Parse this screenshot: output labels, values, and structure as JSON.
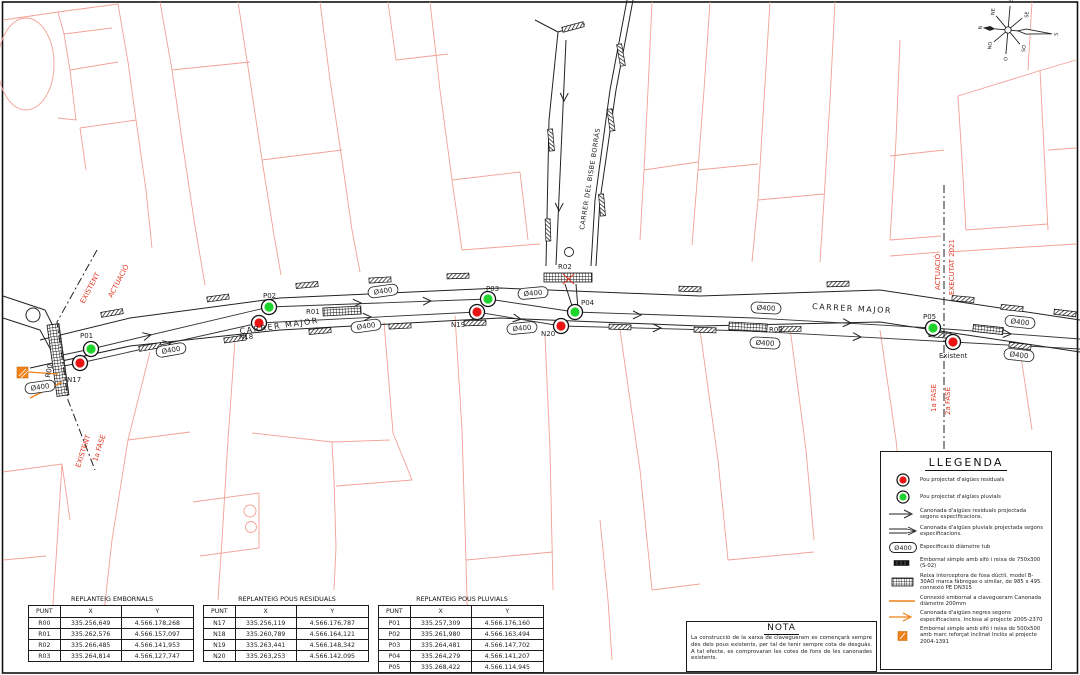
{
  "drawing": {
    "streets": {
      "carrer_major": "CARRER MAJOR",
      "carrer_bisbe": "CARRER DEL BISBE BORRÀS"
    },
    "diameter_label": "Ø400",
    "points": {
      "pluvial": [
        "P01",
        "P02",
        "P03",
        "P04",
        "P05"
      ],
      "residual": [
        "N17",
        "N18",
        "N19",
        "N20"
      ],
      "reixes": [
        "R00",
        "R01",
        "R02",
        "R03"
      ],
      "existent": "Existent"
    },
    "phases": {
      "left_top": [
        "EXISTENT",
        "ACTUACIÓ"
      ],
      "left_bottom": [
        "EXISTENT",
        "1a FASE"
      ],
      "right_top": [
        "ACTUACIÓ",
        "EXECUTAT 2021"
      ],
      "right_bottom": [
        "1a FASE",
        "2a FASE"
      ]
    },
    "compass": [
      "N",
      "NE",
      "E",
      "SE",
      "S",
      "SO",
      "O",
      "NO"
    ]
  },
  "legend": {
    "title": "LLEGENDA",
    "items": [
      {
        "symbol": "pou-residual-icon",
        "label": "Pou projectat d'aigües residuals"
      },
      {
        "symbol": "pou-pluvial-icon",
        "label": "Pou projectat d'aigües pluvials"
      },
      {
        "symbol": "pipe-residual-icon",
        "label": "Canonada d'aigües residuals projectada segons especificacions."
      },
      {
        "symbol": "pipe-pluvial-icon",
        "label": "Canonada d'aigües pluvials projectada segons especificacions."
      },
      {
        "symbol": "diameter-badge-icon",
        "label": "Especificació diàmetre tub"
      },
      {
        "symbol": "embornal-icon",
        "label": "Embornal simple amb sifó i reixa de 750x300 (S-02)"
      },
      {
        "symbol": "reixa-icon",
        "label": "Reixa interceptora de fosa dúctil, model B-30AO marca fàbregas o similar, de 985 x 495. connexió PE DN315"
      },
      {
        "symbol": "connexio-icon",
        "label": "Connexió embornal a clavegueram Canonada diàmetre 200mm"
      },
      {
        "symbol": "negres-icon",
        "label": "Canonada d'aigües negres segons especificacions. Inclosa al projecte 2005-2370"
      },
      {
        "symbol": "embornal-500-icon",
        "label": "Embornal simple amb sifó i reixa de 500x500 amb marc reforçat inclinat Inclòs al projecte 2004-1391"
      }
    ]
  },
  "note": {
    "title": "NOTA",
    "body": "La construcció de la xarxa de clavegueram es començarà sempre des dels pous existents, per tal de tenir sempre cota de desguàs. A tal efecte, es comprovaran les cotes de fons de les canonades existents."
  },
  "tables": [
    {
      "title": "REPLANTEIG EMBORNALS",
      "headers": [
        "PUNT",
        "X",
        "Y"
      ],
      "rows": [
        [
          "R00",
          "335.256,649",
          "4.566.178,268"
        ],
        [
          "R01",
          "335.262,576",
          "4.566.157,097"
        ],
        [
          "R02",
          "335.266,485",
          "4.566.141,953"
        ],
        [
          "R03",
          "335.264,814",
          "4.566.127,747"
        ]
      ]
    },
    {
      "title": "REPLANTEIG POUS RESIDUALS",
      "headers": [
        "PUNT",
        "X",
        "Y"
      ],
      "rows": [
        [
          "N17",
          "335.256,119",
          "4.566.176,787"
        ],
        [
          "N18",
          "335.260,789",
          "4.566.164,121"
        ],
        [
          "N19",
          "335.263,441",
          "4.566.148,342"
        ],
        [
          "N20",
          "335.263,253",
          "4.566.142,095"
        ]
      ]
    },
    {
      "title": "REPLANTEIG POUS PLUVIALS",
      "headers": [
        "PUNT",
        "X",
        "Y"
      ],
      "rows": [
        [
          "P01",
          "335.257,309",
          "4.566.176,160"
        ],
        [
          "P02",
          "335.261,980",
          "4.566.163,494"
        ],
        [
          "P03",
          "335.264,481",
          "4.566.147,702"
        ],
        [
          "P04",
          "335.264,279",
          "4.566.141,207"
        ],
        [
          "P05",
          "335.268,422",
          "4.566.114,945"
        ]
      ]
    }
  ],
  "colors": {
    "parcel_red": "#f2a196",
    "annotation_red": "#e23a28",
    "orange": "#f08118",
    "pluvial_green": "#1ed32a",
    "residual_red": "#e81414"
  }
}
